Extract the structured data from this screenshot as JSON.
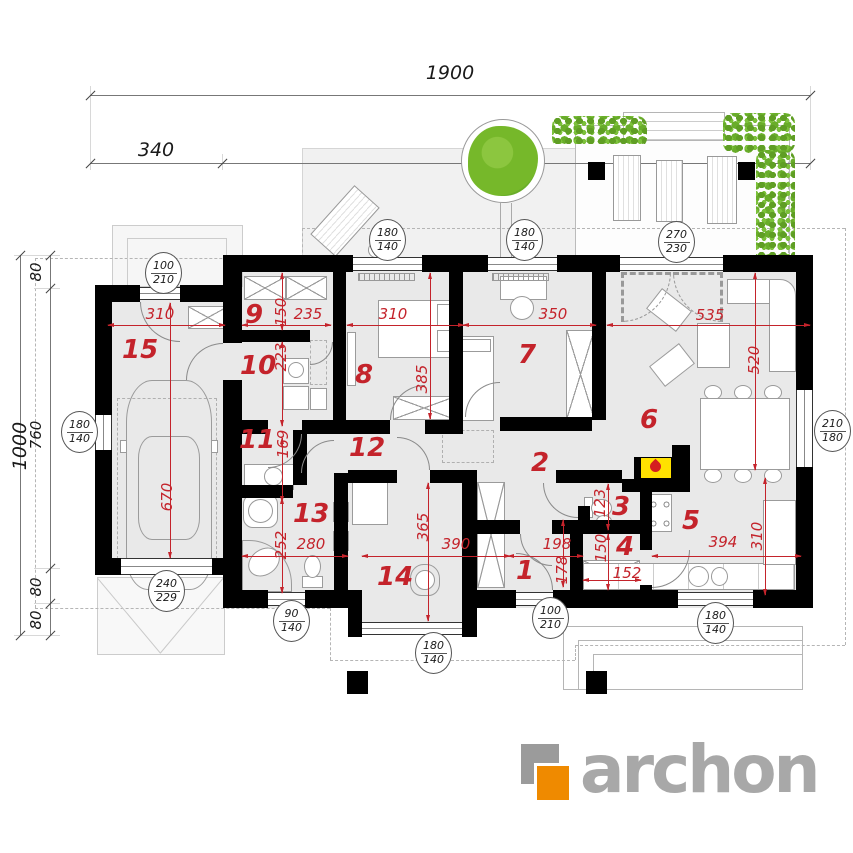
{
  "drawing": {
    "overall_dims": {
      "width_total": "1900",
      "width_seg1": "340",
      "width_seg2": "1560",
      "height_total": "1000",
      "h_seg1": "80",
      "h_seg2": "760",
      "h_seg3": "80",
      "h_seg4": "80"
    },
    "rooms": [
      "1",
      "2",
      "3",
      "4",
      "5",
      "6",
      "7",
      "8",
      "9",
      "10",
      "11",
      "12",
      "13",
      "14",
      "15"
    ],
    "dims": {
      "garage_w": "310",
      "garage_d": "670",
      "r9_d": "150",
      "r9_w": "235",
      "r10_d": "223",
      "r11_d": "169",
      "r13_d": "252",
      "r13_w": "280",
      "r8_w": "310",
      "r8_d": "385",
      "r7_w": "350",
      "r6_w": "535",
      "r6_d": "520",
      "r14_d": "365",
      "r14_w": "390",
      "r1_w": "198",
      "r1_d": "178",
      "r3_d": "123",
      "r4_d": "150",
      "r4_w": "152",
      "r5_w": "394",
      "r5_d": "310"
    },
    "openings": {
      "win_top_a": {
        "w": "180",
        "h": "140"
      },
      "win_top_b": {
        "w": "180",
        "h": "140"
      },
      "door_terrace": {
        "w": "270",
        "h": "230"
      },
      "door_side": {
        "w": "100",
        "h": "210"
      },
      "win_garage_left": {
        "w": "180",
        "h": "140"
      },
      "win_dining": {
        "w": "210",
        "h": "180"
      },
      "garage_door": {
        "w": "240",
        "h": "229"
      },
      "win_bath": {
        "w": "90",
        "h": "140"
      },
      "win_room14": {
        "w": "180",
        "h": "140"
      },
      "door_entry": {
        "w": "100",
        "h": "210"
      },
      "win_kitchen": {
        "w": "180",
        "h": "140"
      }
    },
    "logo": {
      "text": "archon"
    },
    "colors": {
      "dim_red": "#c4232b",
      "plant_green": "#76b82a",
      "logo_orange": "#ef8a00",
      "logo_gray": "#a8a8a8",
      "fireplace_yellow": "#ffe100",
      "wall_black": "#000000"
    }
  }
}
